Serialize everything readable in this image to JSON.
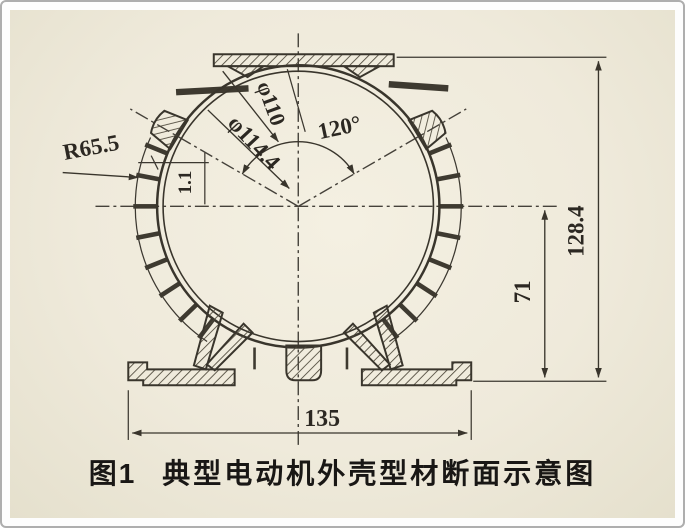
{
  "figure": {
    "caption_label": "图1",
    "caption_title": "典型电动机外壳型材断面示意图"
  },
  "dimensions": {
    "fin_outer_radius": "R65.5",
    "shell_outer_diameter": "φ114.4",
    "shell_inner_diameter": "φ110",
    "lug_angle": "120°",
    "wall_thickness": "1.1",
    "overall_height": "128.4",
    "center_to_base_height": "71",
    "base_width": "135"
  },
  "colors": {
    "paper": "#efeadb",
    "ink": "#39352c",
    "frame_border": "#aeaeae"
  }
}
